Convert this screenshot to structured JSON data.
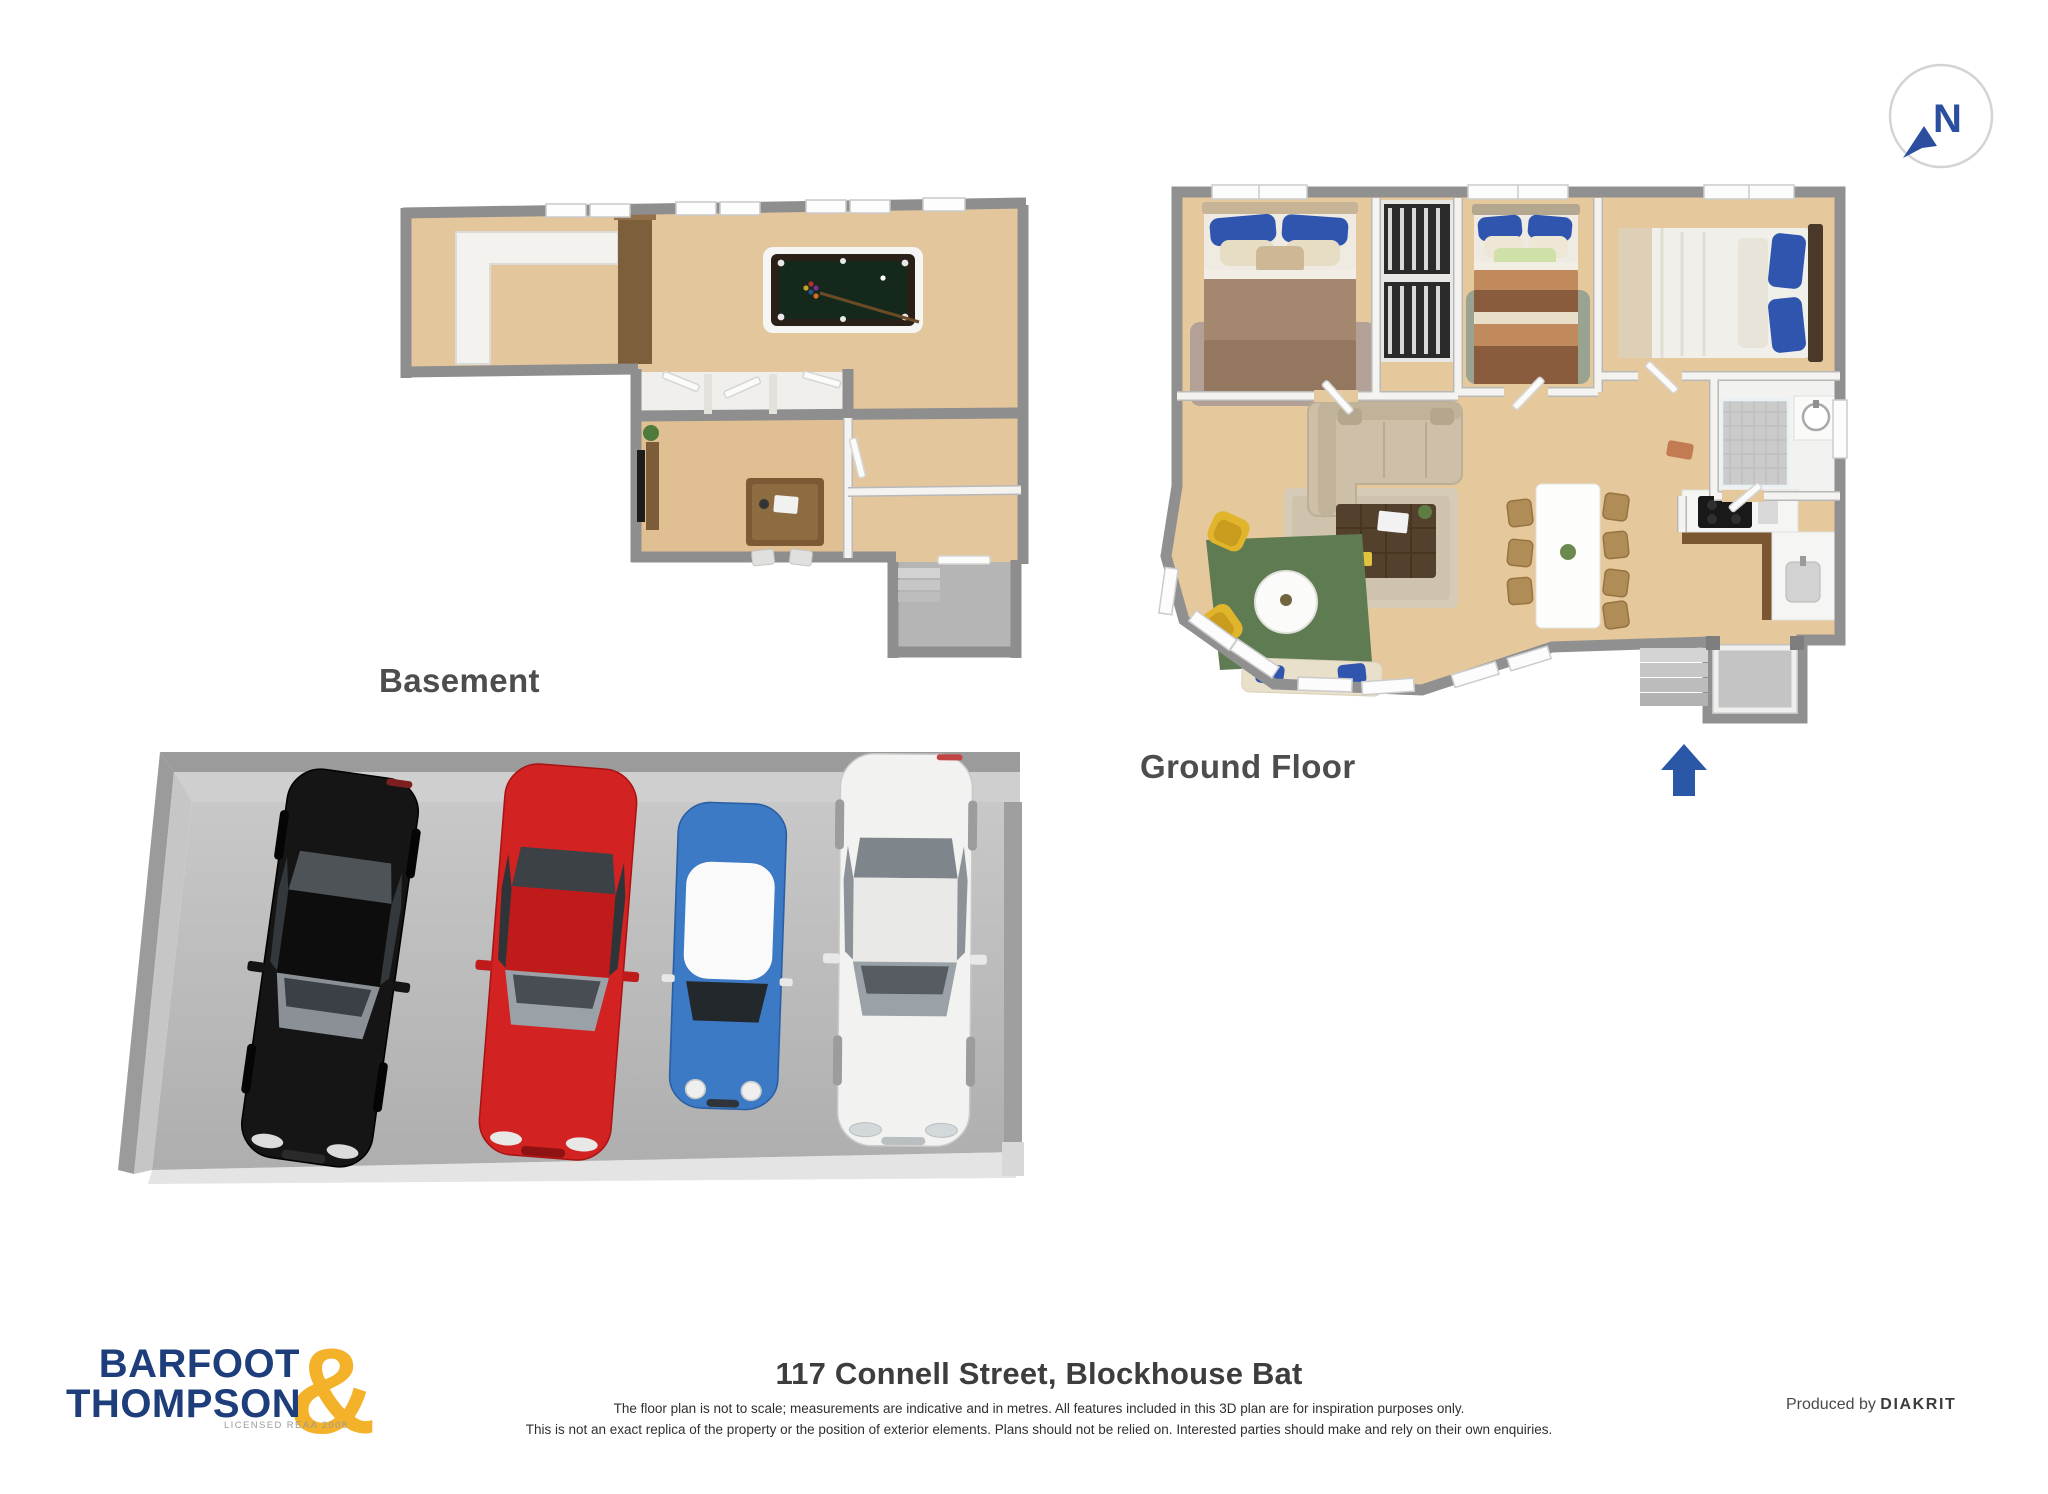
{
  "compass": {
    "label": "N",
    "arrow_color": "#2b4f9e"
  },
  "plans": {
    "basement": {
      "label": "Basement"
    },
    "ground_floor": {
      "label": "Ground Floor",
      "entrance_arrow_color": "#2b57a7"
    }
  },
  "garage": {
    "cars": [
      {
        "name": "black-car",
        "color": "#151515"
      },
      {
        "name": "red-car",
        "color": "#d32222"
      },
      {
        "name": "blue-mini",
        "color": "#3d7ac6",
        "roof_color": "#fafafa"
      },
      {
        "name": "white-car",
        "color": "#f2f2f1"
      }
    ]
  },
  "footer": {
    "logo": {
      "line1": "BARFOOT",
      "line2": "THOMPSON",
      "ampersand": "&",
      "tagline": "LICENSED REAA 2008",
      "navy": "#1d3d7b",
      "gold": "#f3b229"
    },
    "address": "117 Connell Street, Blockhouse Bat",
    "disclaimer1": "The floor plan is not to scale; measurements are indicative and in metres. All features included in this 3D plan are for inspiration purposes only.",
    "disclaimer2": "This is not an exact replica of the property or the position of exterior elements. Plans should not be relied on. Interested parties should make and rely on their own enquiries.",
    "produced_by": "Produced by",
    "producer": "DIAKRIT"
  }
}
